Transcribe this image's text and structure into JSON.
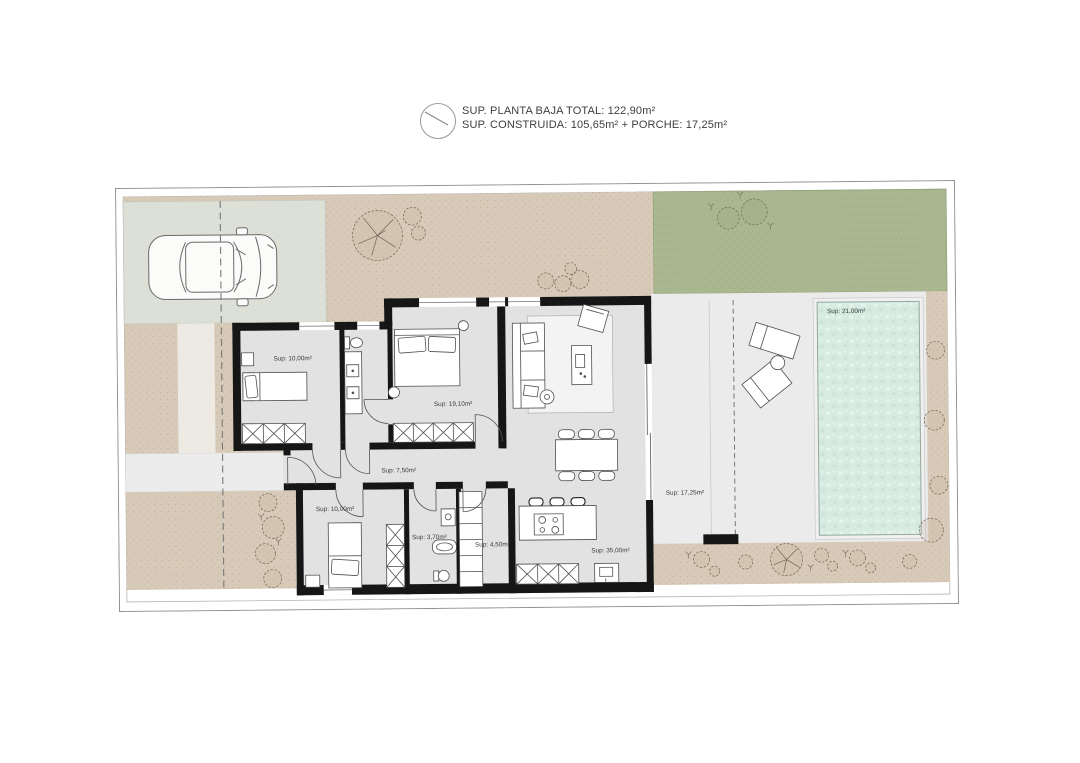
{
  "header": {
    "line1": "SUP. PLANTA BAJA TOTAL: 122,90m²",
    "line2": "SUP. CONSTRUIDA: 105,65m² + PORCHE: 17,25m²"
  },
  "plan": {
    "labels": {
      "bedroom_1": "Sup: 10,00m²",
      "master_bedroom": "Sup: 19,10m²",
      "hallway": "Sup: 7,50m²",
      "bedroom_2": "Sup: 10,00m²",
      "bathroom": "Sup: 3,70m²",
      "laundry": "Sup: 4,50m²",
      "kitchen_living": "Sup: 35,00m²",
      "porch": "Sup: 17,25m²",
      "pool": "Sup: 21,00m²"
    }
  },
  "colors": {
    "ground": "#d8cab8",
    "lawn": "#aab890",
    "driveway": "#dce0d6",
    "terrace": "#ebebeb",
    "room_floor": "#e2e2e2",
    "pool_water": "#d7ebe2",
    "wall": "#161616"
  }
}
